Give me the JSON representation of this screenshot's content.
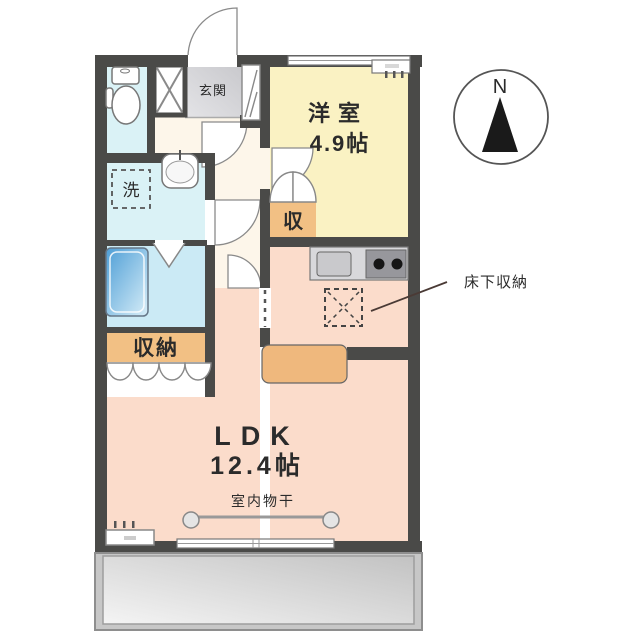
{
  "plan": {
    "rooms": {
      "western_room": {
        "name": "洋室",
        "size": "4.9帖"
      },
      "ldk": {
        "name": "LDK",
        "size": "12.4帖"
      },
      "entrance": {
        "name": "玄関"
      },
      "closet": {
        "name": "収納"
      },
      "room_closet": {
        "name": "収"
      },
      "laundry": {
        "name": "洗"
      }
    },
    "labels": {
      "indoor_drying": "室内物干",
      "underfloor_storage": "床下収納",
      "compass_north": "N"
    },
    "colors": {
      "wall": "#4a4a48",
      "western_room_floor": "#faf2c3",
      "ldk_floor": "#fbdccb",
      "hall_floor": "#fdf6ea",
      "toilet_floor": "#daf2f6",
      "bath_floor": "#cbeaf5",
      "closet_fill": "#f2c084",
      "entrance_fill": "#d6d6d9",
      "balcony_fill": "#c7c7c7",
      "bathtub_blue": "#4e9ed6"
    }
  }
}
